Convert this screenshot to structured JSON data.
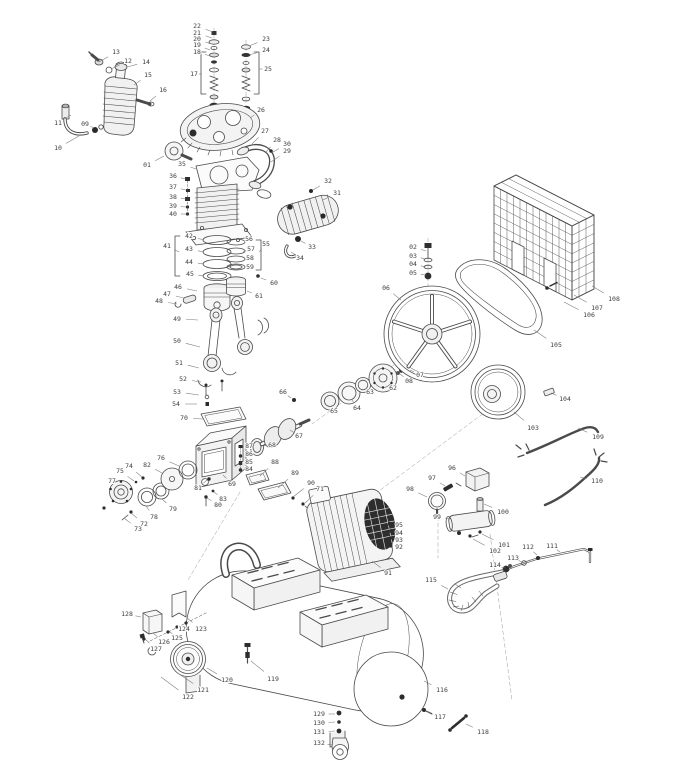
{
  "colors": {
    "background": "#ffffff",
    "line_art": "#4a4a4a",
    "dark_fill": "#2c2c2c",
    "label_text": "#3d3d3d",
    "leader_line": "#7a7a7a"
  },
  "diagram": {
    "type": "exploded-parts-diagram",
    "subject": "belt-driven air compressor exploded view",
    "part_count": 132,
    "labels": [
      [
        "01",
        147,
        165,
        164,
        156
      ],
      [
        "02",
        413,
        247,
        426,
        251
      ],
      [
        "03",
        413,
        256,
        426,
        259
      ],
      [
        "04",
        413,
        264,
        426,
        267
      ],
      [
        "05",
        413,
        273,
        426,
        275
      ],
      [
        "06",
        386,
        288,
        401,
        300
      ],
      [
        "07",
        420,
        375,
        410,
        370
      ],
      [
        "08",
        409,
        381,
        400,
        374
      ],
      [
        "09",
        85,
        124,
        94,
        128
      ],
      [
        "10",
        58,
        148,
        79,
        136
      ],
      [
        "11",
        58,
        123,
        71,
        115
      ],
      [
        "12",
        128,
        61,
        111,
        69
      ],
      [
        "13",
        116,
        52,
        99,
        62
      ],
      [
        "14",
        146,
        62,
        127,
        67
      ],
      [
        "15",
        148,
        75,
        134,
        85
      ],
      [
        "16",
        163,
        90,
        150,
        101
      ],
      [
        "17",
        194,
        74,
        202,
        74
      ],
      [
        "18",
        197,
        52,
        210,
        56
      ],
      [
        "19",
        197,
        45,
        210,
        50
      ],
      [
        "20",
        197,
        39,
        211,
        44
      ],
      [
        "21",
        197,
        33,
        212,
        38
      ],
      [
        "22",
        197,
        26,
        213,
        32
      ],
      [
        "23",
        266,
        39,
        249,
        46
      ],
      [
        "24",
        266,
        50,
        249,
        55
      ],
      [
        "25",
        268,
        69,
        259,
        69
      ],
      [
        "26",
        261,
        110,
        250,
        118
      ],
      [
        "27",
        265,
        131,
        252,
        144
      ],
      [
        "28",
        277,
        140,
        265,
        153
      ],
      [
        "29",
        287,
        151,
        271,
        162
      ],
      [
        "30",
        287,
        144,
        273,
        152
      ],
      [
        "31",
        337,
        193,
        323,
        200
      ],
      [
        "32",
        328,
        181,
        313,
        190
      ],
      [
        "33",
        312,
        247,
        301,
        241
      ],
      [
        "34",
        300,
        258,
        291,
        252
      ],
      [
        "35",
        182,
        164,
        196,
        169
      ],
      [
        "36",
        173,
        176,
        186,
        179
      ],
      [
        "37",
        173,
        187,
        186,
        190
      ],
      [
        "38",
        173,
        197,
        186,
        199
      ],
      [
        "39",
        173,
        206,
        186,
        207
      ],
      [
        "40",
        173,
        214,
        186,
        214
      ],
      [
        "41",
        167,
        246,
        179,
        252
      ],
      [
        "42",
        189,
        236,
        204,
        240
      ],
      [
        "43",
        189,
        249,
        204,
        252
      ],
      [
        "44",
        189,
        262,
        204,
        264
      ],
      [
        "45",
        190,
        274,
        204,
        276
      ],
      [
        "46",
        178,
        287,
        197,
        291
      ],
      [
        "47",
        167,
        294,
        184,
        298
      ],
      [
        "48",
        159,
        301,
        177,
        304
      ],
      [
        "49",
        177,
        319,
        198,
        320
      ],
      [
        "50",
        177,
        341,
        200,
        347
      ],
      [
        "51",
        179,
        363,
        199,
        368
      ],
      [
        "52",
        183,
        379,
        201,
        382
      ],
      [
        "53",
        177,
        392,
        199,
        395
      ],
      [
        "54",
        176,
        404,
        197,
        404
      ],
      [
        "55",
        266,
        244,
        259,
        252
      ],
      [
        "56",
        249,
        239,
        243,
        243
      ],
      [
        "57",
        251,
        249,
        243,
        252
      ],
      [
        "58",
        250,
        258,
        243,
        259
      ],
      [
        "59",
        250,
        267,
        243,
        267
      ],
      [
        "60",
        274,
        283,
        261,
        278
      ],
      [
        "61",
        259,
        296,
        247,
        291
      ],
      [
        "62",
        393,
        388,
        389,
        384
      ],
      [
        "63",
        370,
        392,
        365,
        388
      ],
      [
        "64",
        357,
        408,
        352,
        400
      ],
      [
        "65",
        334,
        411,
        331,
        405
      ],
      [
        "66",
        283,
        392,
        291,
        398
      ],
      [
        "67",
        299,
        436,
        290,
        430
      ],
      [
        "68",
        272,
        445,
        263,
        446
      ],
      [
        "69",
        232,
        484,
        223,
        475
      ],
      [
        "70",
        184,
        418,
        203,
        419
      ],
      [
        "71",
        320,
        489,
        305,
        503
      ],
      [
        "72",
        144,
        524,
        131,
        513
      ],
      [
        "73",
        138,
        529,
        124,
        518
      ],
      [
        "74",
        129,
        466,
        142,
        477
      ],
      [
        "75",
        120,
        471,
        134,
        481
      ],
      [
        "76",
        161,
        458,
        179,
        466
      ],
      [
        "77",
        112,
        481,
        115,
        485
      ],
      [
        "78",
        154,
        517,
        146,
        506
      ],
      [
        "79",
        173,
        509,
        162,
        499
      ],
      [
        "80",
        218,
        505,
        207,
        498
      ],
      [
        "81",
        198,
        488,
        207,
        480
      ],
      [
        "82",
        147,
        465,
        162,
        473
      ],
      [
        "83",
        223,
        499,
        214,
        492
      ],
      [
        "84",
        249,
        469,
        242,
        470
      ],
      [
        "85",
        249,
        462,
        242,
        463
      ],
      [
        "86",
        249,
        454,
        242,
        456
      ],
      [
        "87",
        249,
        446,
        242,
        448
      ],
      [
        "88",
        275,
        462,
        260,
        476
      ],
      [
        "89",
        295,
        473,
        278,
        488
      ],
      [
        "90",
        311,
        483,
        293,
        497
      ],
      [
        "91",
        388,
        573,
        372,
        561
      ],
      [
        "92",
        399,
        547,
        392,
        546
      ],
      [
        "93",
        399,
        540,
        392,
        540
      ],
      [
        "94",
        399,
        533,
        392,
        533
      ],
      [
        "95",
        399,
        525,
        392,
        526
      ],
      [
        "96",
        452,
        468,
        465,
        476
      ],
      [
        "97",
        432,
        478,
        445,
        486
      ],
      [
        "98",
        410,
        489,
        427,
        497
      ],
      [
        "99",
        437,
        517,
        451,
        519
      ],
      [
        "100",
        503,
        512,
        484,
        504
      ],
      [
        "101",
        504,
        545,
        482,
        534
      ],
      [
        "102",
        495,
        551,
        473,
        539
      ],
      [
        "103",
        533,
        428,
        514,
        412
      ],
      [
        "104",
        565,
        399,
        551,
        393
      ],
      [
        "105",
        556,
        345,
        534,
        330
      ],
      [
        "106",
        589,
        315,
        564,
        302
      ],
      [
        "107",
        597,
        308,
        574,
        295
      ],
      [
        "108",
        614,
        299,
        592,
        286
      ],
      [
        "109",
        598,
        437,
        578,
        428
      ],
      [
        "110",
        597,
        481,
        580,
        477
      ],
      [
        "111",
        552,
        546,
        560,
        552
      ],
      [
        "112",
        528,
        547,
        537,
        555
      ],
      [
        "113",
        513,
        558,
        522,
        562
      ],
      [
        "114",
        495,
        565,
        505,
        568
      ],
      [
        "115",
        431,
        580,
        448,
        589
      ],
      [
        "116",
        442,
        690,
        424,
        681
      ],
      [
        "117",
        440,
        717,
        427,
        711
      ],
      [
        "118",
        483,
        732,
        466,
        724
      ],
      [
        "119",
        273,
        679,
        251,
        661
      ],
      [
        "120",
        227,
        680,
        207,
        668
      ],
      [
        "121",
        203,
        690,
        176,
        672
      ],
      [
        "122",
        188,
        697,
        161,
        677
      ],
      [
        "123",
        201,
        629,
        187,
        618
      ],
      [
        "124",
        184,
        629,
        178,
        625
      ],
      [
        "125",
        177,
        638,
        169,
        631
      ],
      [
        "126",
        164,
        642,
        153,
        633
      ],
      [
        "127",
        156,
        649,
        145,
        639
      ],
      [
        "128",
        127,
        614,
        141,
        617
      ],
      [
        "129",
        319,
        714,
        335,
        714
      ],
      [
        "130",
        319,
        723,
        335,
        722
      ],
      [
        "131",
        319,
        732,
        335,
        731
      ],
      [
        "132",
        319,
        743,
        333,
        745
      ]
    ]
  }
}
